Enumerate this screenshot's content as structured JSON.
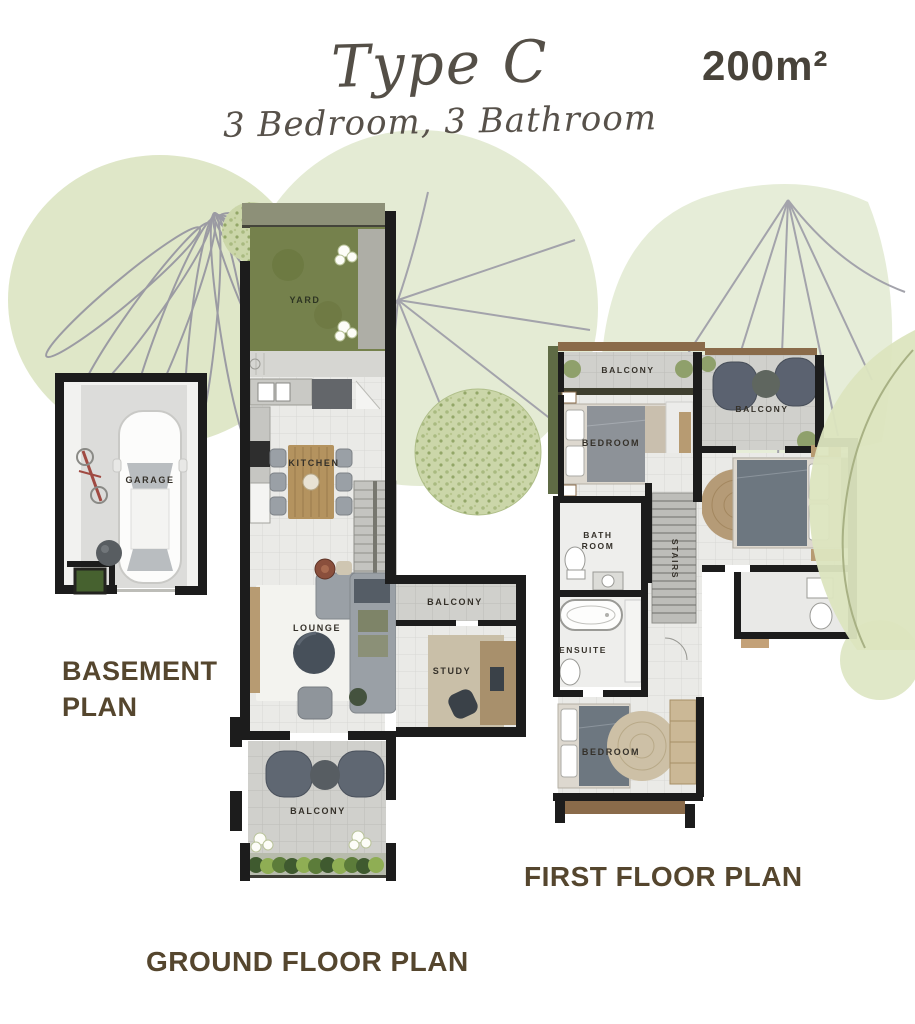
{
  "header": {
    "title": "Type C",
    "subtitle": "3 Bedroom, 3 Bathroom",
    "area": "200m²"
  },
  "basement": {
    "title": "BASEMENT PLAN",
    "garage": "GARAGE"
  },
  "ground": {
    "title": "GROUND FLOOR PLAN",
    "yard": "YARD",
    "kitchen": "KITCHEN",
    "lounge": "LOUNGE",
    "balcony_side": "BALCONY",
    "study": "STUDY",
    "balcony_front": "BALCONY"
  },
  "first": {
    "title": "FIRST FLOOR PLAN",
    "balcony_left": "BALCONY",
    "balcony_right": "BALCONY",
    "bedroom_top": "BEDROOM",
    "bathroom": "BATH ROOM",
    "stairs": "STAIRS",
    "ensuite": "ENSUITE",
    "bedroom_bottom": "BEDROOM"
  },
  "colors": {
    "plan_title": "#55462E",
    "wall": "#1C1C1C",
    "yard_green": "#75814C",
    "leaf_green": "#E2E9CE",
    "wood": "#B4935F",
    "room_label": "#35312A"
  }
}
